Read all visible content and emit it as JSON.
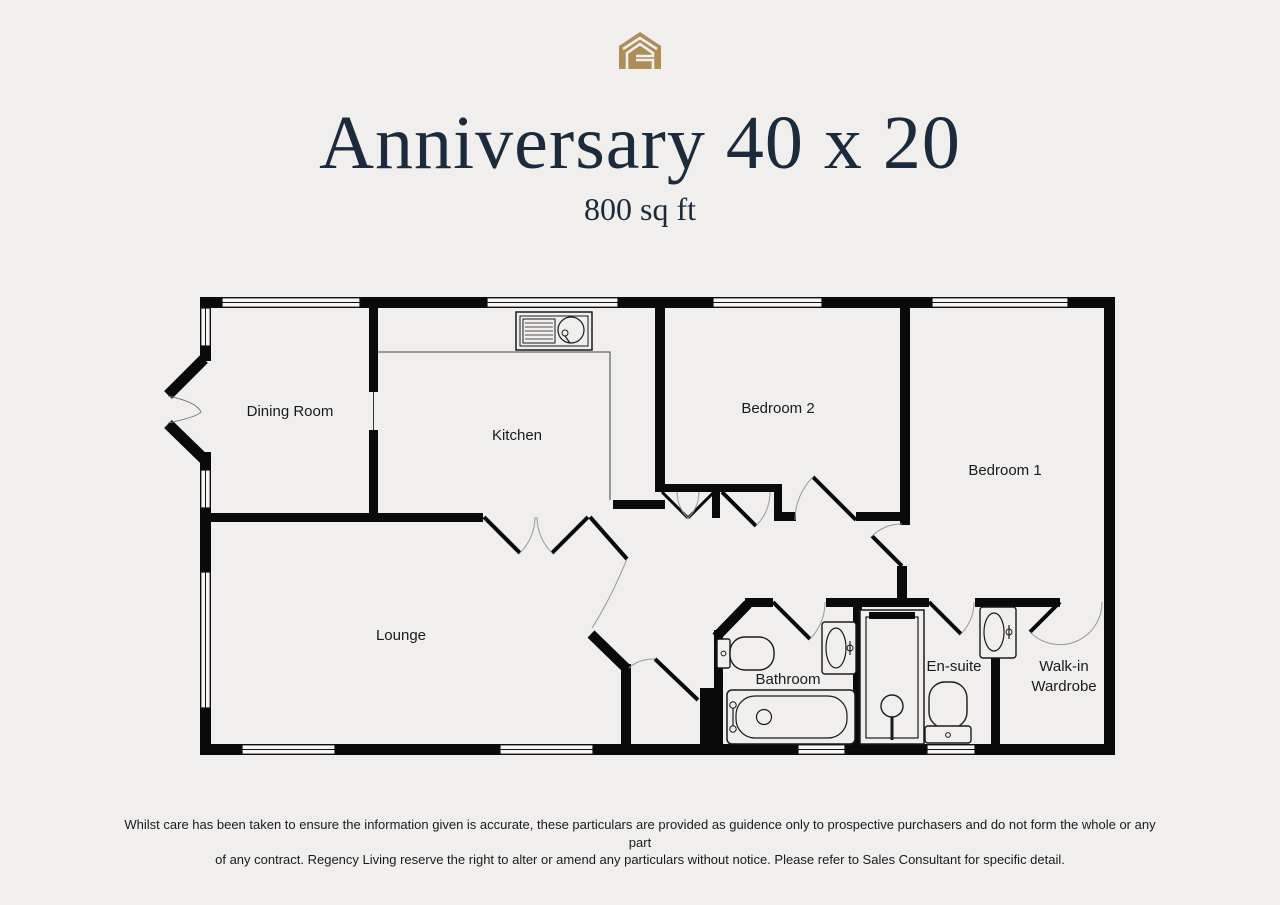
{
  "page": {
    "background": "#f0efed"
  },
  "logo": {
    "name": "regency-living-house-logo",
    "color": "#ad8d58"
  },
  "header": {
    "title": "Anniversary 40 x 20",
    "subtitle": "800 sq ft",
    "title_color": "#1c2b3c"
  },
  "floorplan": {
    "wall_color": "#0a0a0a",
    "rooms": {
      "dining": "Dining Room",
      "kitchen": "Kitchen",
      "bedroom2": "Bedroom 2",
      "bedroom1": "Bedroom 1",
      "lounge": "Lounge",
      "bathroom": "Bathroom",
      "ensuite": "En-suite",
      "wardrobe_line1": "Walk-in",
      "wardrobe_line2": "Wardrobe"
    },
    "fixtures": [
      "kitchen-sink-icon",
      "bath-icon",
      "toilet-icon",
      "basin-icon",
      "shower-icon",
      "toilet-icon",
      "basin-icon"
    ]
  },
  "footer": {
    "disclaimer_line1": "Whilst care has been taken to ensure the information given is accurate, these particulars are provided as guidence only to prospective purchasers and do not form the whole or any part",
    "disclaimer_line2": "of any contract. Regency Living reserve the right to alter or amend any particulars without notice. Please refer to Sales Consultant for specific detail."
  }
}
